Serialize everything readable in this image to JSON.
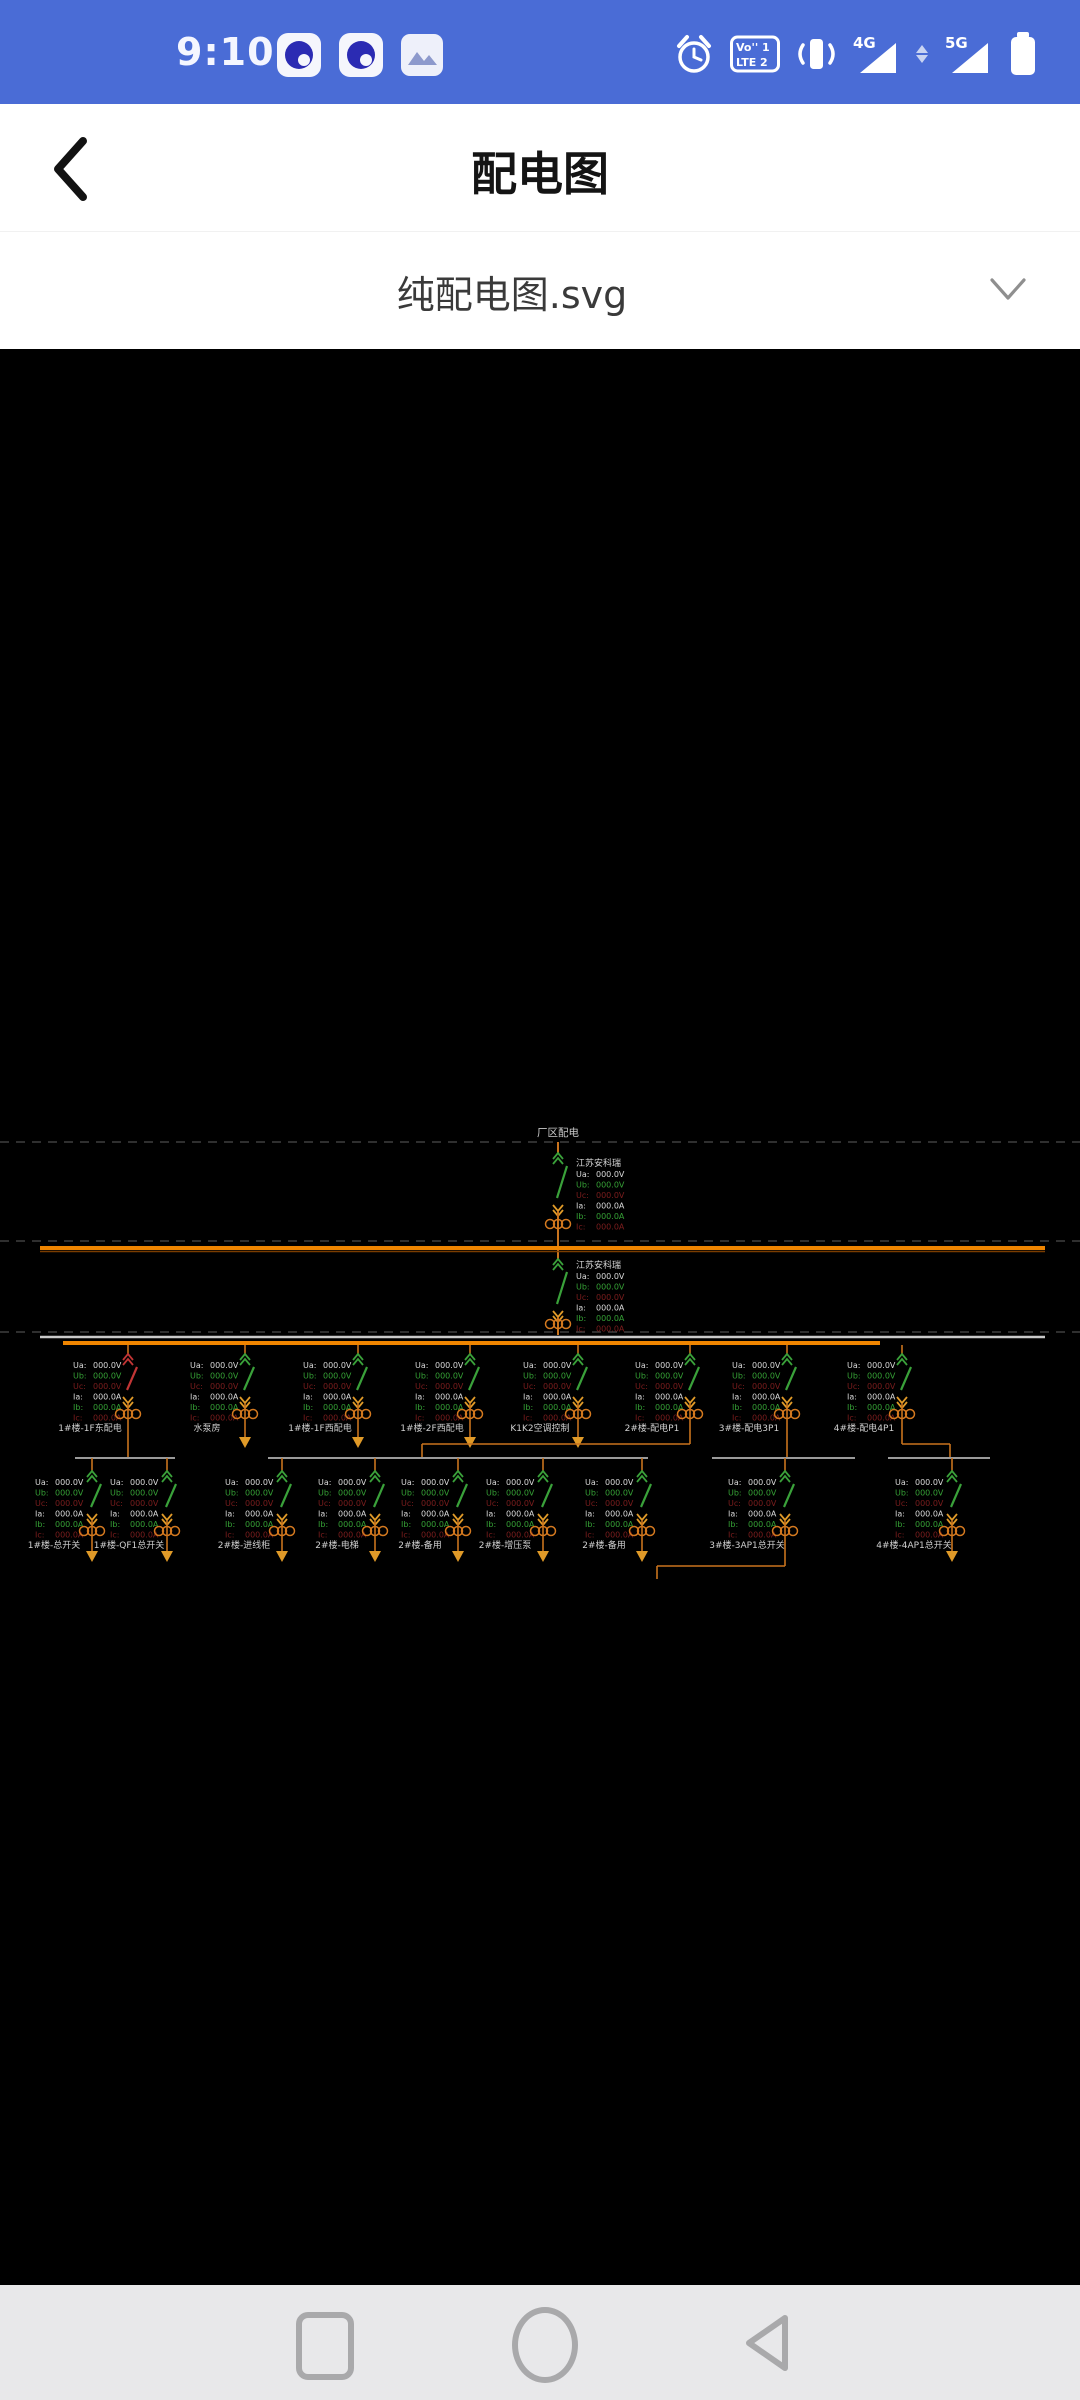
{
  "status_bar": {
    "time": "9:10",
    "volte_l1": "Vo'' 1",
    "volte_l2": "LTE 2",
    "net_4g": "4G",
    "net_5g": "5G",
    "bg_color": "#4a6cd6"
  },
  "header": {
    "title": "配电图"
  },
  "file_selector": {
    "value": "纯配电图.svg"
  },
  "diagram": {
    "source_title": "厂区配电",
    "vendor": "江苏安科瑞",
    "readings": [
      {
        "k": "Ua:",
        "v": "000.0V",
        "c": "#d9d9d9"
      },
      {
        "k": "Ub:",
        "v": "000.0V",
        "c": "#35a035"
      },
      {
        "k": "Uc:",
        "v": "000.0V",
        "c": "#7c1d1d"
      },
      {
        "k": "Ia:",
        "v": "000.0A",
        "c": "#d9d9d9"
      },
      {
        "k": "Ib:",
        "v": "000.0A",
        "c": "#35a035"
      },
      {
        "k": "Ic:",
        "v": "000.0A",
        "c": "#7c1d1d"
      }
    ],
    "colors": {
      "line": "#c9731d",
      "bus": "#ef8500",
      "bus_shadow": "#7a3c00",
      "neutral_bus": "#c9c9c9",
      "group_bus": "#9a9a9a",
      "dashed": "#3f3f3f",
      "green": "#3aa13a",
      "red": "#c23535",
      "orange": "#e09a28",
      "ct": "#d4791f",
      "label": "#cfcfcf",
      "title": "#c9c9c9",
      "vendor": "#d6d6d6"
    },
    "incomers": [
      {
        "vendor": "江苏安科瑞"
      },
      {
        "vendor": "江苏安科瑞"
      }
    ],
    "row1": [
      {
        "label": "1#楼-1F东配电",
        "x": 128,
        "blade": "red",
        "end": "bus"
      },
      {
        "label": "水泵房",
        "x": 245,
        "blade": "green",
        "end": "arrow"
      },
      {
        "label": "1#楼-1F西配电",
        "x": 358,
        "blade": "green",
        "end": "arrow"
      },
      {
        "label": "1#楼-2F西配电",
        "x": 470,
        "blade": "green",
        "end": "arrow"
      },
      {
        "label": "K1K2空调控制",
        "x": 578,
        "blade": "green",
        "end": "arrow"
      },
      {
        "label": "2#楼-配电P1",
        "x": 690,
        "blade": "green",
        "end": "jog_left",
        "jog_x": 422
      },
      {
        "label": "3#楼-配电3P1",
        "x": 787,
        "blade": "green",
        "end": "bus"
      },
      {
        "label": "4#楼-配电4P1",
        "x": 902,
        "blade": "green",
        "end": "jog_right",
        "jog_x": 950
      }
    ],
    "row2": [
      {
        "label": "1#楼-总开关",
        "x": 92,
        "end": "arrow"
      },
      {
        "label": "1#楼-QF1总开关",
        "x": 167,
        "end": "arrow"
      },
      {
        "label": "2#楼-进线柜",
        "x": 282,
        "end": "arrow"
      },
      {
        "label": "2#楼-电梯",
        "x": 375,
        "end": "arrow"
      },
      {
        "label": "2#楼-备用",
        "x": 458,
        "end": "arrow"
      },
      {
        "label": "2#楼-增压泵",
        "x": 543,
        "end": "arrow"
      },
      {
        "label": "2#楼-备用",
        "x": 642,
        "end": "arrow"
      },
      {
        "label": "3#楼-3AP1总开关",
        "x": 785,
        "end": "jog_left_long",
        "jog_x": 657
      },
      {
        "label": "4#楼-4AP1总开关",
        "x": 952,
        "end": "arrow"
      }
    ],
    "row2_buses": [
      [
        75,
        175
      ],
      [
        268,
        648
      ],
      [
        712,
        855
      ],
      [
        888,
        990
      ]
    ]
  },
  "nav_bar": {
    "icons": [
      "recents",
      "home",
      "back"
    ]
  }
}
